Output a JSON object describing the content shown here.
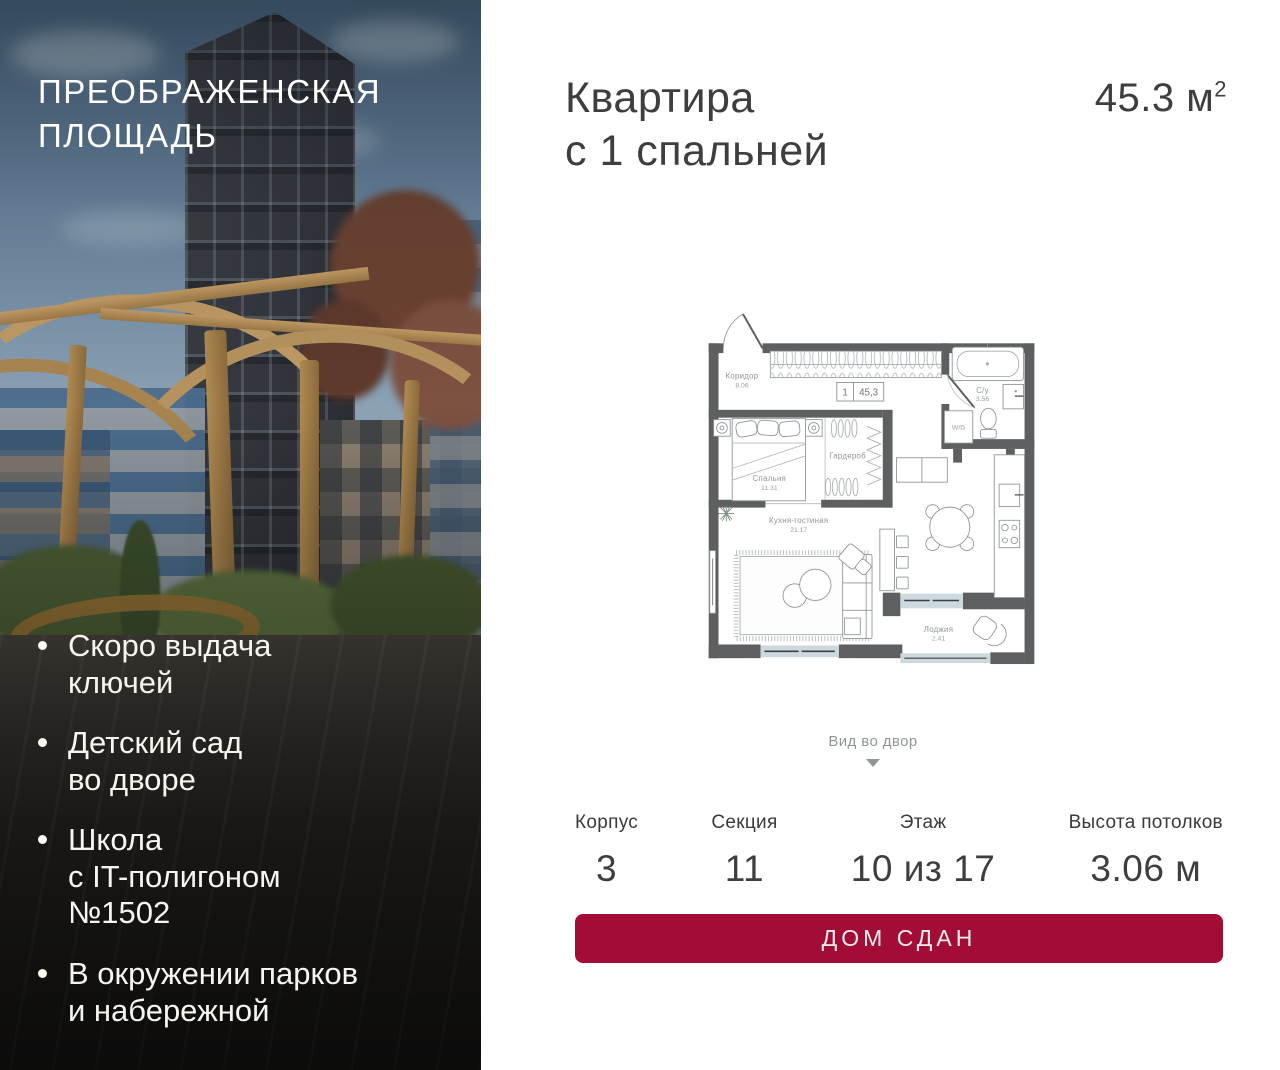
{
  "project": {
    "name": "ПРЕОБРАЖЕНСКАЯ\nПЛОЩАДЬ",
    "features": [
      "Скоро выдача\nключей",
      "Детский сад\nво дворе",
      "Школа\nс IT-полигоном\n№1502",
      "В окружении парков\nи набережной"
    ]
  },
  "apartment": {
    "title": "Квартира\nс 1 спальней",
    "area_text": "45.3 м",
    "area_sup": "2"
  },
  "floor_plan": {
    "unit_number": "1",
    "unit_area": "45,3",
    "view_note": "Вид во двор",
    "rooms": [
      {
        "name": "Коридор",
        "area": "8.06"
      },
      {
        "name": "С/у",
        "area": "3.56"
      },
      {
        "name": "W/D",
        "area": ""
      },
      {
        "name": "Спальня",
        "area": "11.31"
      },
      {
        "name": "Гардероб",
        "area": ""
      },
      {
        "name": "Кухня-гостиная",
        "area": "21.17"
      },
      {
        "name": "Лоджия",
        "area": "2.41"
      }
    ]
  },
  "details": {
    "columns": [
      {
        "label": "Корпус",
        "value": "3"
      },
      {
        "label": "Секция",
        "value": "11"
      },
      {
        "label": "Этаж",
        "value": "10 из 17"
      },
      {
        "label": "Высота потолков",
        "value": "3.06 м"
      }
    ]
  },
  "cta": {
    "label": "ДОМ СДАН"
  },
  "colors": {
    "accent": "#A30D35",
    "wall": "#5d5f60",
    "window": "#ccd9de"
  }
}
